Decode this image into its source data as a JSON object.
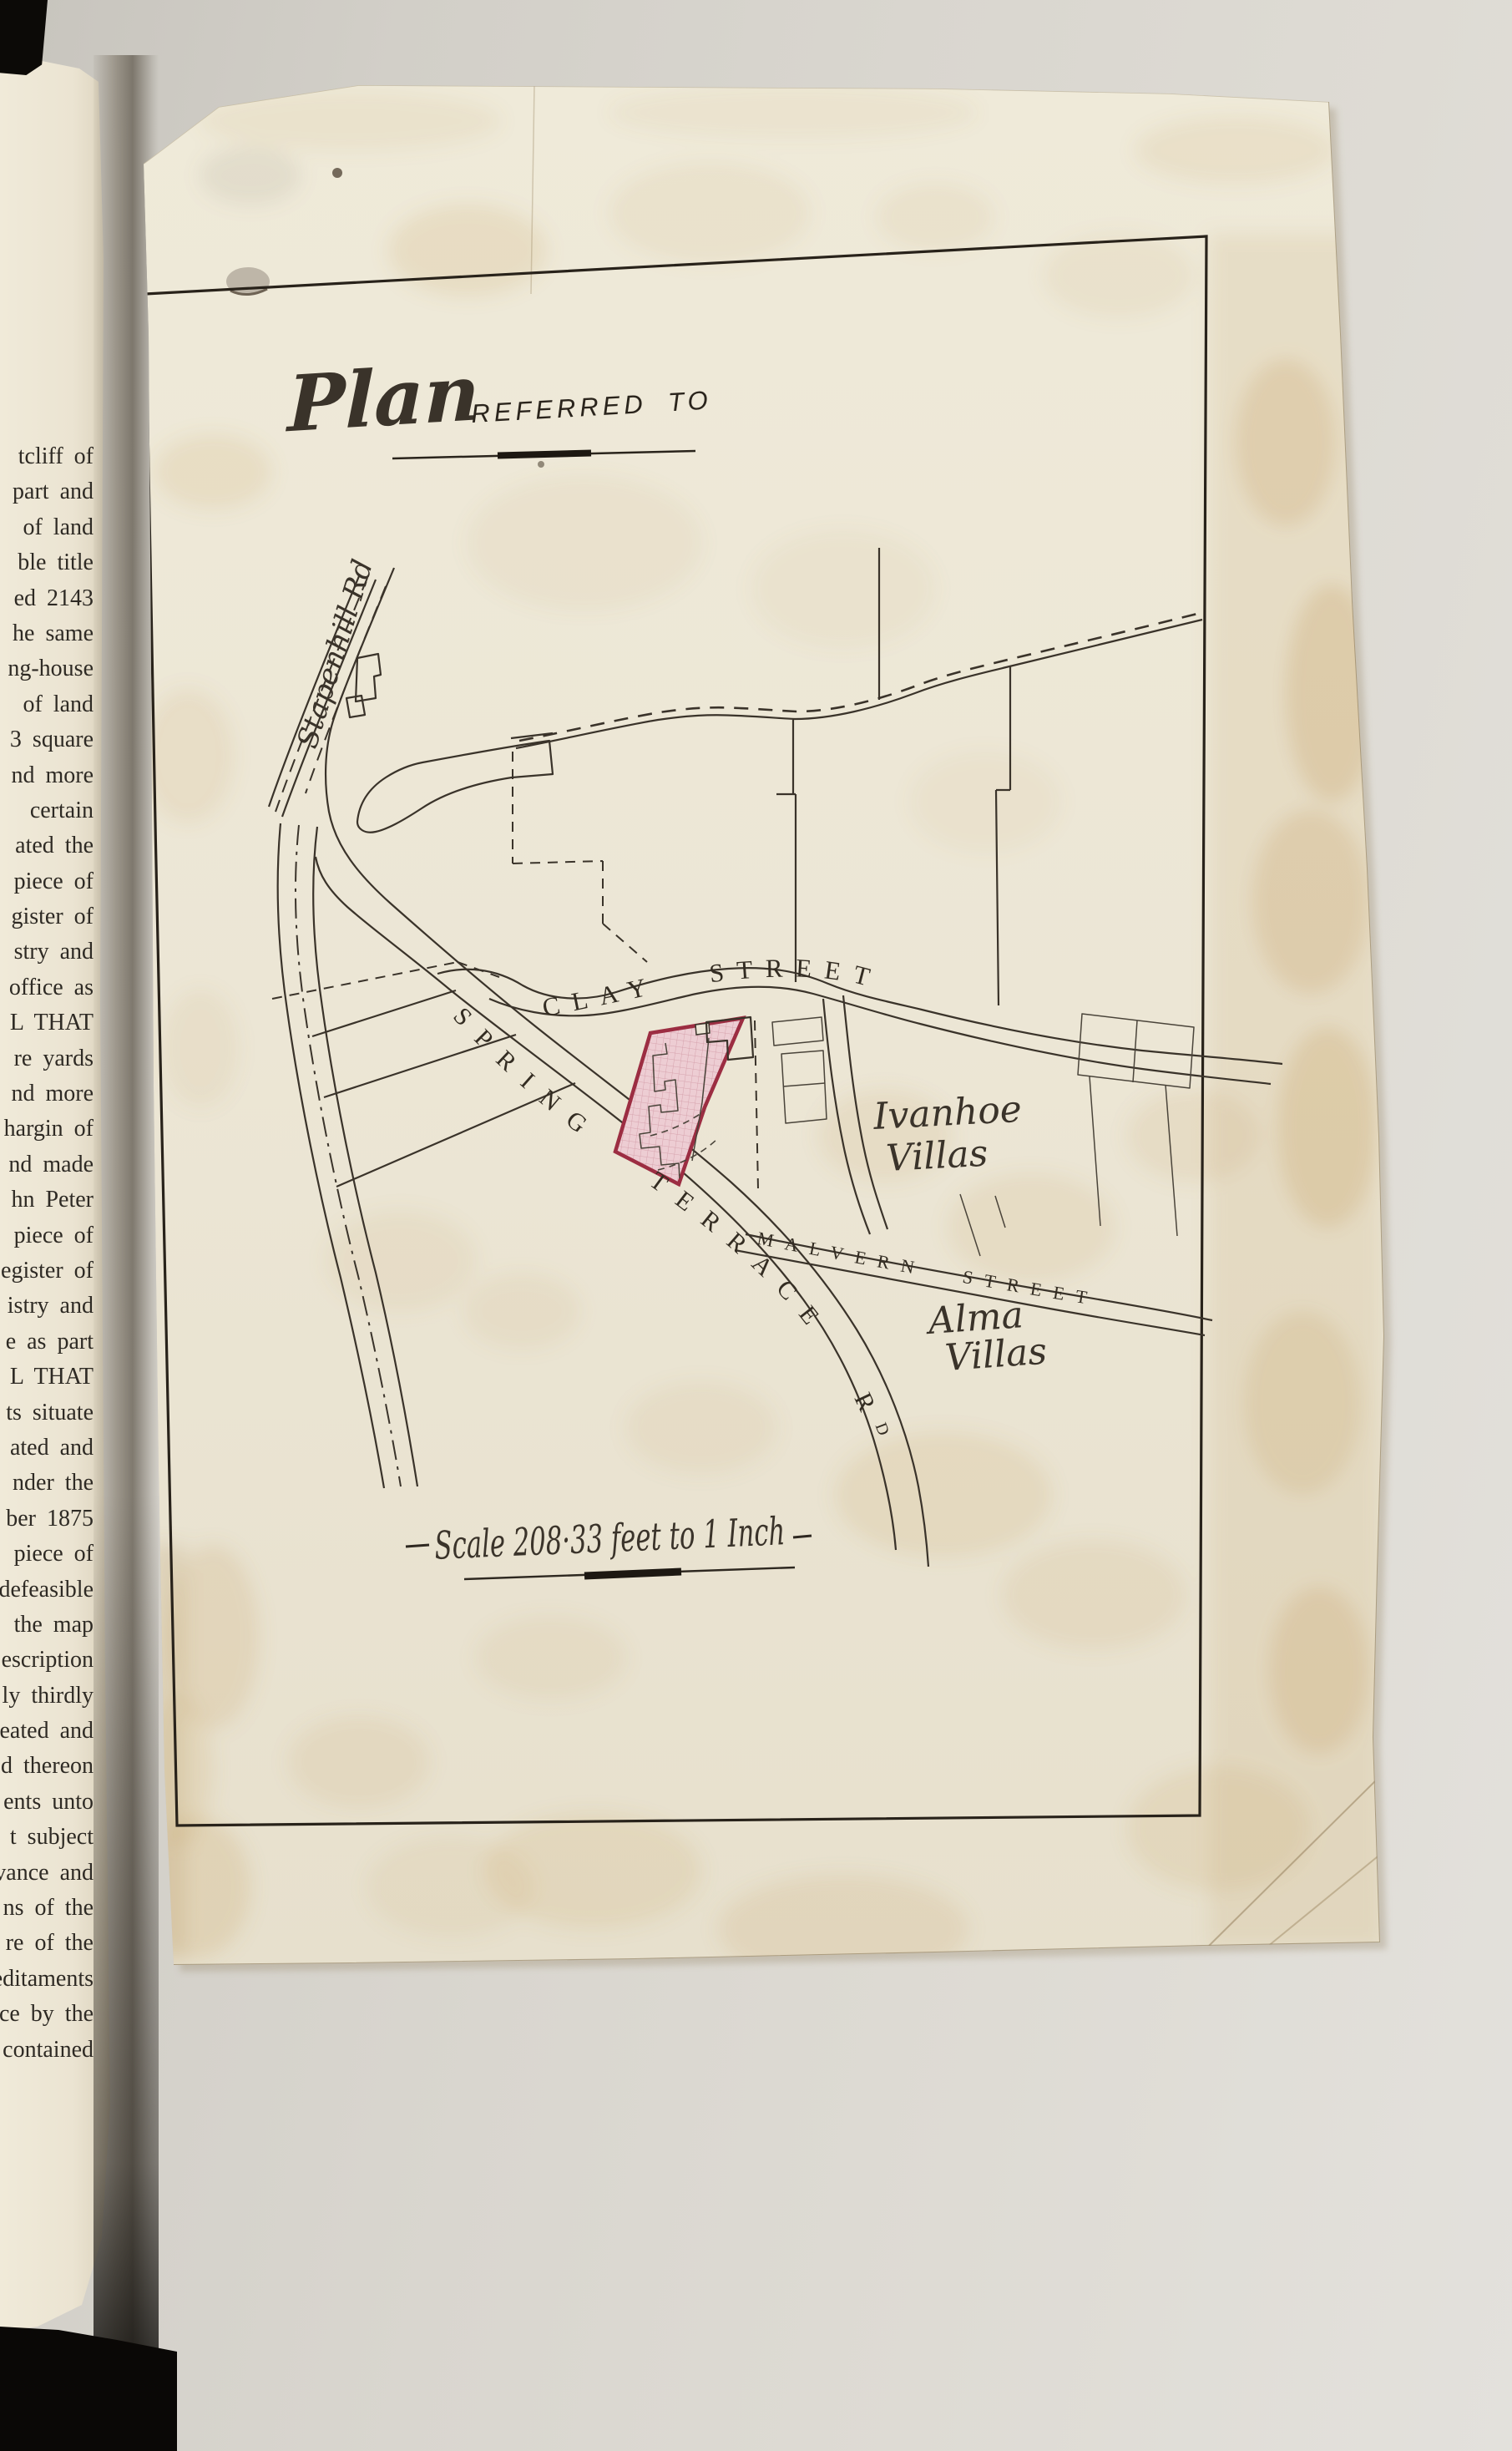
{
  "colors": {
    "background": "#d7d4cd",
    "binding_black": "#0c0a07",
    "book_page": "#ebe4d2",
    "plan_paper": "#ece6d6",
    "ink": "#3a332a",
    "plot_fill": "#edcdd3",
    "plot_border": "#9c2d42",
    "stain": "#c49a58"
  },
  "book_margin_text": [
    "tcliff of",
    "part and",
    "of land",
    "ble title",
    "ed 2143",
    "he same",
    "ng-house",
    "of land",
    "3 square",
    "nd more",
    "certain",
    "ated the",
    "piece of",
    "gister of",
    "stry and",
    "office as",
    "L THAT",
    "re yards",
    "nd more",
    "hargin of",
    "nd made",
    "hn Peter",
    "piece of",
    "egister of",
    "istry and",
    "e as part",
    "L THAT",
    "ts situate",
    "ated and",
    "nder the",
    "ber 1875",
    "piece of",
    "defeasible",
    "the map",
    "escription",
    "ly thirdly",
    "eated and",
    "d thereon",
    "ents unto",
    "t subject",
    "vance and",
    "ns of the",
    "re of the",
    "editaments",
    "nce by the",
    "contained"
  ],
  "plan": {
    "title": {
      "script": "Plan",
      "caps": "REFERRED TO"
    },
    "scale": {
      "caption": "Scale 208·33 feet to 1 Inch"
    },
    "streets": {
      "stapenhill": "Stapenhill Rd",
      "clay": "CLAY STREET",
      "spring_main": "SPRING TERRACE R",
      "spring_sup": "D",
      "malvern": "MALVERN STREET"
    },
    "places": {
      "ivanhoe": [
        "Ivanhoe",
        "Villas"
      ],
      "alma": [
        "Alma",
        "Villas"
      ]
    }
  }
}
